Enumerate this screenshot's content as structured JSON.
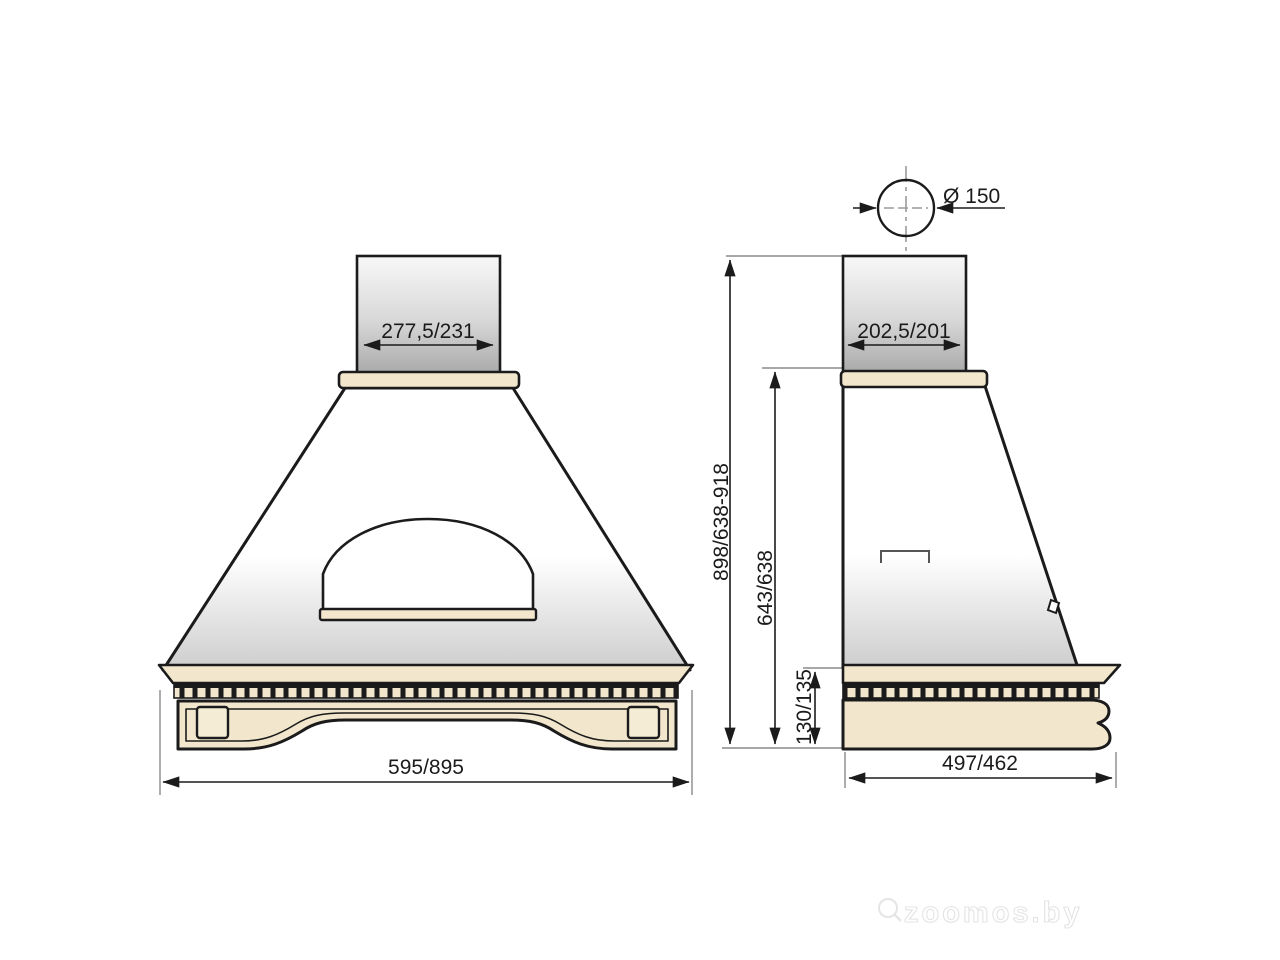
{
  "drawing": {
    "description": "Dimensional technical drawing of a kitchen range hood, front and side views",
    "front_view": {
      "duct_width_label": "277,5/231",
      "base_width_label": "595/895"
    },
    "side_view": {
      "duct_diameter_label": "Ø 150",
      "duct_depth_label": "202,5/201",
      "overall_height_label": "898/638-918",
      "body_height_label": "643/638",
      "base_height_label": "130/135",
      "base_depth_label": "497/462"
    },
    "watermark": "zoomos.by",
    "colors": {
      "outline": "#1b1b1b",
      "wood_trim": "#f2e7cc",
      "duct_gradient_top": "#f7f7f7",
      "duct_gradient_bottom": "#aaaaaa",
      "body_gradient_bottom": "#cdcdcd",
      "dimension_line": "#1b1b1b",
      "extension_line": "#8a8a8a"
    }
  }
}
